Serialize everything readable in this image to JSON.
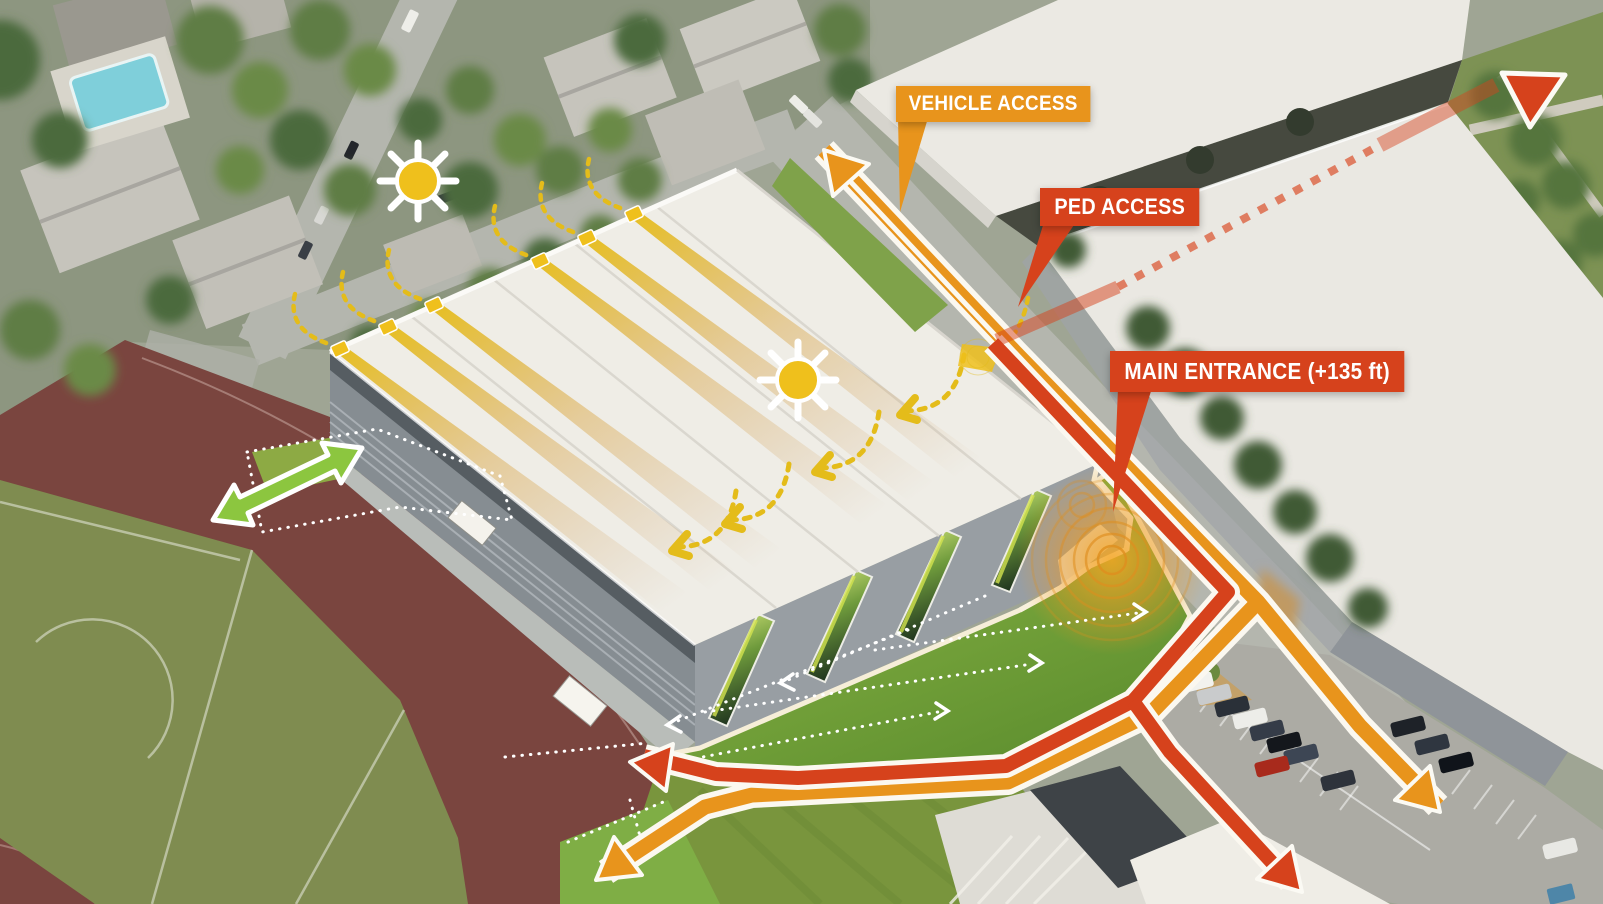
{
  "callouts": {
    "vehicle_access": "VEHICLE ACCESS",
    "ped_access": "PED ACCESS",
    "main_entrance": "MAIN ENTRANCE (+135 ft)"
  },
  "colors": {
    "route_vehicle": "#E8941C",
    "route_ped": "#D6421C",
    "callout_text": "#FFFFFF",
    "casing": "#FBF8F0",
    "sun": "#EFC01C",
    "sun_dash": "#E4BC1A",
    "field_arrow": "#8CC63F",
    "sight_dots": "#FFFFFF",
    "roof": "#EFEDE6",
    "track": "#7A453F",
    "field": "#7F8C50",
    "lawn": "#85B13F",
    "road": "#B4B6AE",
    "parking": "#ACABA4",
    "pool": "#7FCFDA"
  }
}
